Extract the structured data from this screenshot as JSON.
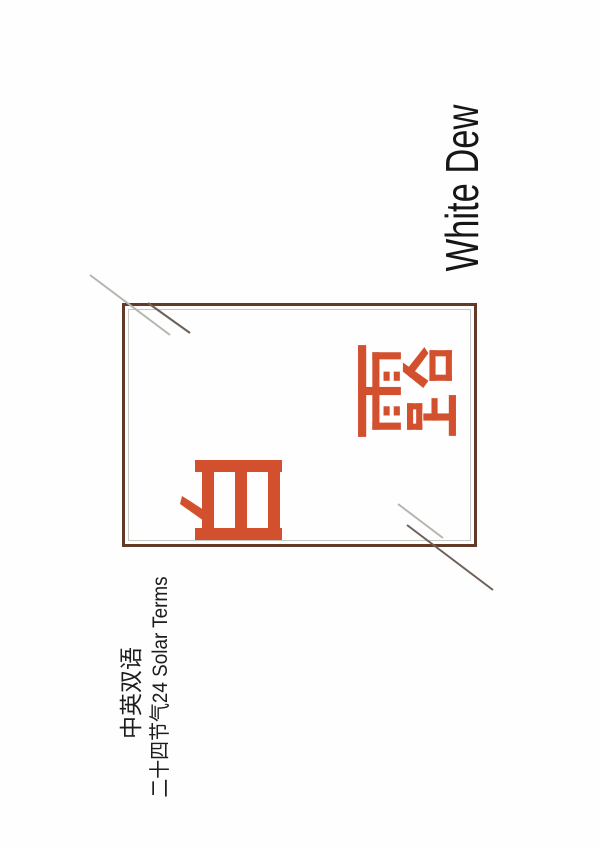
{
  "title": {
    "en": "White Dew",
    "zh_chars": [
      "白",
      "露"
    ],
    "zh_word": "白露"
  },
  "subtitle": {
    "line1": "中英双语",
    "line2": "二十四节气24 Solar Terms"
  },
  "colors": {
    "accent_orange": "#d2502e",
    "frame_brown": "#613a28",
    "inner_rule_gray": "#c8c8c2",
    "diagonal_light": "#b6b6ae",
    "diagonal_dark": "#6f6057",
    "text_black": "#161616",
    "background": "#fefefe"
  }
}
